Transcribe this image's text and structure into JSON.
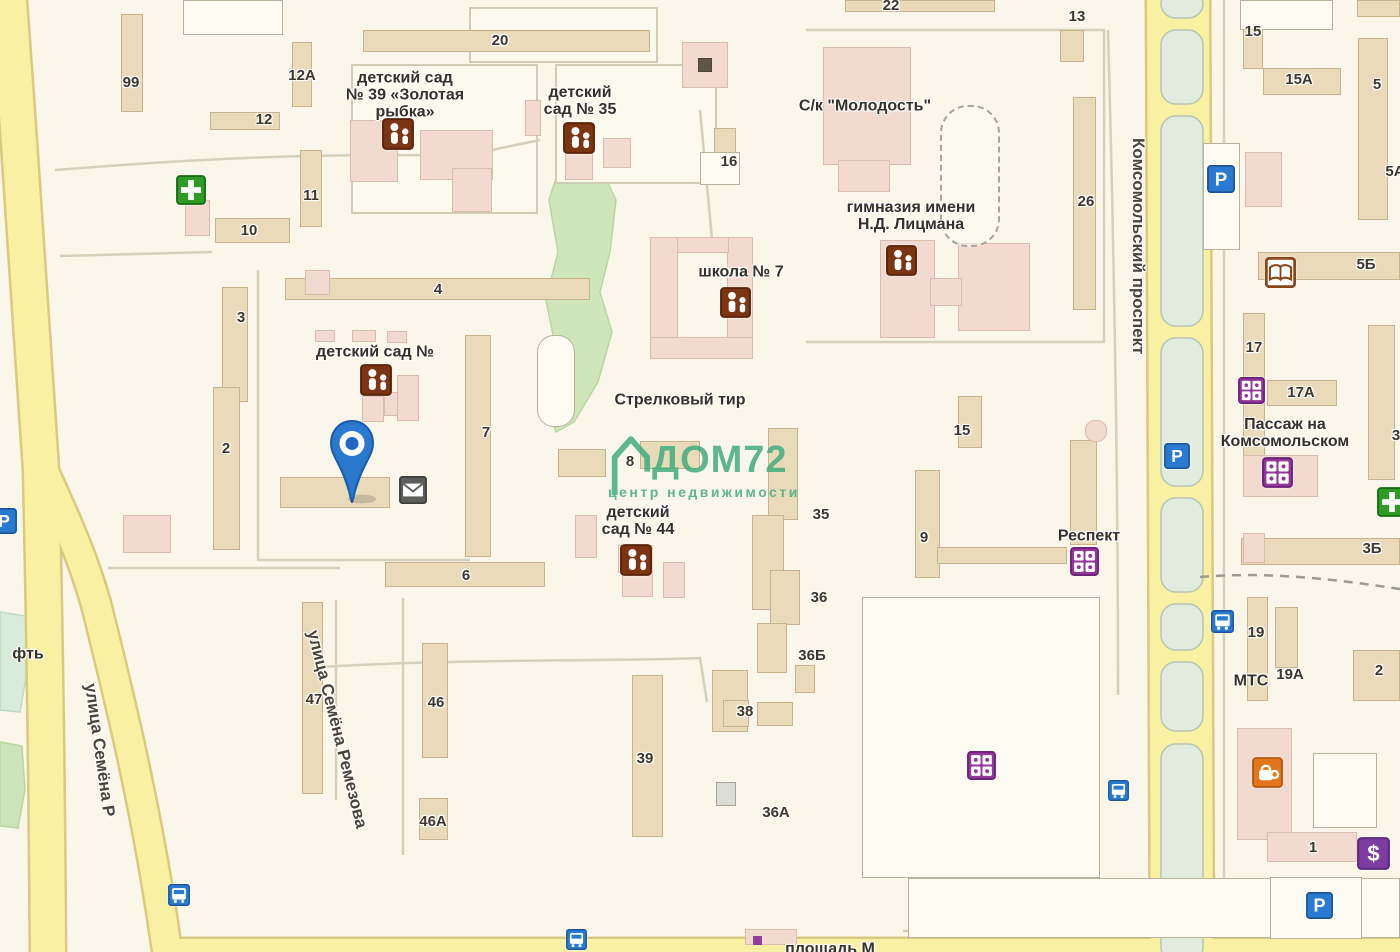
{
  "map": {
    "bg": "#faf6ea",
    "watermark": {
      "line1": "ДОМ72",
      "line2": "центр недвижимости",
      "color": "#43ad7c"
    },
    "pin": {
      "x": 352,
      "y": 504
    },
    "palette": {
      "road": "#f8f1a4",
      "road_casing": "#d8ca80",
      "building_tan": "#e9dbba",
      "building_pink": "#f2dad1",
      "green": "#cfe6ba",
      "median": "#e1ecdf",
      "icon_blue": "#2a7ad2",
      "icon_green": "#2f9b27",
      "icon_purple": "#93379b",
      "icon_brown": "#7c3512",
      "icon_orange": "#e2761b"
    },
    "median_x": 1161,
    "median_w": 42,
    "medians": [
      [
        -10,
        18
      ],
      [
        30,
        104
      ],
      [
        116,
        326
      ],
      [
        338,
        486
      ],
      [
        498,
        592
      ],
      [
        604,
        650
      ],
      [
        662,
        731
      ],
      [
        744,
        962
      ]
    ],
    "roads": [
      {
        "d": "M 8,-12 C 20,150 31,320 41,470 C 45,640 47,800 48,962",
        "w": 34
      },
      {
        "d": "M 41,465 C 60,508 80,548 96,604 C 116,684 148,810 168,958",
        "w": 28
      },
      {
        "d": "M 1178,-10 C 1181,200 1182,500 1182,962",
        "w": 62
      },
      {
        "d": "M 160,949 L 1406,949",
        "w": 20
      }
    ],
    "greens": [
      {
        "p": "575,148 600,166 616,200 610,252 600,292 612,332 598,382 574,422 556,432 546,400 556,350 546,300 558,252 549,200 560,165",
        "f": "#cfe6ba",
        "s": "#b9d6a2"
      },
      {
        "p": "0,612 26,616 29,660 20,712 0,710",
        "f": "#d9ecd9",
        "s": "#c2d9c2"
      },
      {
        "p": "0,742 22,746 25,790 18,828 0,826",
        "f": "#cde4ba",
        "s": "#b9d6a2"
      }
    ],
    "blocks": [
      "M 352,65 H 537 V 213 H 352 Z",
      "M 556,65 H 716 V 183 H 556 Z",
      "M 470,8 H 657 V 62 H 470 Z"
    ],
    "lanes": [
      {
        "d": "M 55,170 C 180,160 320,152 462,156 L 540,140"
      },
      {
        "d": "M 60,256 L 212,252"
      },
      {
        "d": "M 806,30 L 1104,30 L 1104,342 L 806,342"
      },
      {
        "d": "M 258,270 L 258,560 L 470,560"
      },
      {
        "d": "M 108,568 L 340,568"
      },
      {
        "d": "M 336,600 L 336,800"
      },
      {
        "d": "M 403,598 L 403,855"
      },
      {
        "d": "M 305,668 C 460,658 600,662 700,658 L 707,702"
      },
      {
        "d": "M 1224,0 L 1224,933"
      },
      {
        "d": "M 1108,30 C 1114,250 1118,460 1118,695"
      },
      {
        "d": "M 903,931 L 1400,931"
      },
      {
        "d": "M 700,110 L 713,250"
      },
      {
        "d": "M 1200,577 C 1270,571 1340,580 1400,589",
        "dash": "9 7",
        "c": "#9b9b93"
      }
    ],
    "buildings": [
      {
        "x": 121,
        "y": 14,
        "w": 22,
        "h": 98,
        "t": "t"
      },
      {
        "x": 292,
        "y": 42,
        "w": 20,
        "h": 65,
        "t": "t"
      },
      {
        "x": 210,
        "y": 112,
        "w": 70,
        "h": 18,
        "t": "t"
      },
      {
        "x": 300,
        "y": 150,
        "w": 22,
        "h": 77,
        "t": "t"
      },
      {
        "x": 215,
        "y": 218,
        "w": 75,
        "h": 25,
        "t": "t"
      },
      {
        "x": 363,
        "y": 30,
        "w": 287,
        "h": 22,
        "t": "t"
      },
      {
        "x": 845,
        "y": 0,
        "w": 150,
        "h": 12,
        "t": "t"
      },
      {
        "x": 1060,
        "y": 30,
        "w": 24,
        "h": 32,
        "t": "t"
      },
      {
        "x": 714,
        "y": 128,
        "w": 22,
        "h": 26,
        "t": "t"
      },
      {
        "x": 1073,
        "y": 97,
        "w": 23,
        "h": 213,
        "t": "t"
      },
      {
        "x": 285,
        "y": 278,
        "w": 305,
        "h": 22,
        "t": "t"
      },
      {
        "x": 222,
        "y": 287,
        "w": 26,
        "h": 115,
        "t": "t"
      },
      {
        "x": 213,
        "y": 387,
        "w": 27,
        "h": 163,
        "t": "t"
      },
      {
        "x": 465,
        "y": 335,
        "w": 26,
        "h": 222,
        "t": "t"
      },
      {
        "x": 280,
        "y": 477,
        "w": 110,
        "h": 31,
        "t": "t"
      },
      {
        "x": 558,
        "y": 449,
        "w": 48,
        "h": 28,
        "t": "t"
      },
      {
        "x": 640,
        "y": 441,
        "w": 60,
        "h": 28,
        "t": "t"
      },
      {
        "x": 385,
        "y": 562,
        "w": 160,
        "h": 25,
        "t": "t"
      },
      {
        "x": 768,
        "y": 428,
        "w": 30,
        "h": 92,
        "t": "t"
      },
      {
        "x": 752,
        "y": 515,
        "w": 32,
        "h": 95,
        "t": "t"
      },
      {
        "x": 770,
        "y": 570,
        "w": 30,
        "h": 55,
        "t": "t"
      },
      {
        "x": 757,
        "y": 623,
        "w": 30,
        "h": 50,
        "t": "t"
      },
      {
        "x": 712,
        "y": 670,
        "w": 36,
        "h": 62,
        "t": "t"
      },
      {
        "x": 795,
        "y": 665,
        "w": 20,
        "h": 28,
        "t": "t"
      },
      {
        "x": 757,
        "y": 702,
        "w": 36,
        "h": 24,
        "t": "t"
      },
      {
        "x": 723,
        "y": 700,
        "w": 26,
        "h": 27,
        "t": "t"
      },
      {
        "x": 632,
        "y": 675,
        "w": 31,
        "h": 162,
        "t": "t"
      },
      {
        "x": 422,
        "y": 643,
        "w": 26,
        "h": 115,
        "t": "t"
      },
      {
        "x": 419,
        "y": 798,
        "w": 29,
        "h": 42,
        "t": "t"
      },
      {
        "x": 302,
        "y": 602,
        "w": 21,
        "h": 192,
        "t": "t"
      },
      {
        "x": 915,
        "y": 470,
        "w": 25,
        "h": 108,
        "t": "t"
      },
      {
        "x": 958,
        "y": 396,
        "w": 24,
        "h": 52,
        "t": "t"
      },
      {
        "x": 1070,
        "y": 440,
        "w": 27,
        "h": 105,
        "t": "t"
      },
      {
        "x": 937,
        "y": 547,
        "w": 130,
        "h": 17,
        "t": "t"
      },
      {
        "x": 1243,
        "y": 7,
        "w": 20,
        "h": 62,
        "t": "t"
      },
      {
        "x": 1263,
        "y": 68,
        "w": 78,
        "h": 27,
        "t": "t"
      },
      {
        "x": 1358,
        "y": 38,
        "w": 30,
        "h": 182,
        "t": "t"
      },
      {
        "x": 1258,
        "y": 252,
        "w": 142,
        "h": 28,
        "t": "t"
      },
      {
        "x": 1243,
        "y": 313,
        "w": 22,
        "h": 152,
        "t": "t"
      },
      {
        "x": 1267,
        "y": 380,
        "w": 70,
        "h": 26,
        "t": "t"
      },
      {
        "x": 1368,
        "y": 325,
        "w": 27,
        "h": 155,
        "t": "t"
      },
      {
        "x": 1241,
        "y": 538,
        "w": 159,
        "h": 27,
        "t": "t"
      },
      {
        "x": 1247,
        "y": 597,
        "w": 21,
        "h": 104,
        "t": "t"
      },
      {
        "x": 1275,
        "y": 607,
        "w": 23,
        "h": 61,
        "t": "t"
      },
      {
        "x": 1353,
        "y": 650,
        "w": 47,
        "h": 51,
        "t": "t"
      },
      {
        "x": 1357,
        "y": 0,
        "w": 43,
        "h": 17,
        "t": "t"
      },
      {
        "x": 185,
        "y": 200,
        "w": 25,
        "h": 36,
        "t": "p"
      },
      {
        "x": 305,
        "y": 270,
        "w": 25,
        "h": 25,
        "t": "p"
      },
      {
        "x": 350,
        "y": 120,
        "w": 48,
        "h": 62,
        "t": "p"
      },
      {
        "x": 420,
        "y": 130,
        "w": 73,
        "h": 50,
        "t": "p"
      },
      {
        "x": 452,
        "y": 168,
        "w": 40,
        "h": 44,
        "t": "p"
      },
      {
        "x": 525,
        "y": 100,
        "w": 16,
        "h": 36,
        "t": "p"
      },
      {
        "x": 565,
        "y": 138,
        "w": 28,
        "h": 42,
        "t": "p"
      },
      {
        "x": 603,
        "y": 138,
        "w": 28,
        "h": 30,
        "t": "p"
      },
      {
        "x": 682,
        "y": 42,
        "w": 46,
        "h": 46,
        "t": "p"
      },
      {
        "x": 698,
        "y": 58,
        "w": 14,
        "h": 14,
        "t": "dark"
      },
      {
        "x": 823,
        "y": 47,
        "w": 88,
        "h": 118,
        "t": "p"
      },
      {
        "x": 838,
        "y": 160,
        "w": 52,
        "h": 32,
        "t": "p"
      },
      {
        "x": 880,
        "y": 240,
        "w": 55,
        "h": 98,
        "t": "p"
      },
      {
        "x": 958,
        "y": 243,
        "w": 72,
        "h": 88,
        "t": "p"
      },
      {
        "x": 930,
        "y": 278,
        "w": 32,
        "h": 28,
        "t": "p"
      },
      {
        "x": 650,
        "y": 237,
        "w": 28,
        "h": 122,
        "t": "p"
      },
      {
        "x": 727,
        "y": 237,
        "w": 26,
        "h": 122,
        "t": "p"
      },
      {
        "x": 650,
        "y": 337,
        "w": 103,
        "h": 22,
        "t": "p"
      },
      {
        "x": 677,
        "y": 237,
        "w": 52,
        "h": 16,
        "t": "p"
      },
      {
        "x": 362,
        "y": 396,
        "w": 22,
        "h": 26,
        "t": "p"
      },
      {
        "x": 384,
        "y": 392,
        "w": 15,
        "h": 24,
        "t": "p"
      },
      {
        "x": 397,
        "y": 375,
        "w": 22,
        "h": 46,
        "t": "p"
      },
      {
        "x": 315,
        "y": 330,
        "w": 20,
        "h": 12,
        "t": "p"
      },
      {
        "x": 352,
        "y": 330,
        "w": 24,
        "h": 12,
        "t": "p"
      },
      {
        "x": 387,
        "y": 331,
        "w": 20,
        "h": 12,
        "t": "p"
      },
      {
        "x": 575,
        "y": 515,
        "w": 22,
        "h": 43,
        "t": "p"
      },
      {
        "x": 622,
        "y": 572,
        "w": 31,
        "h": 25,
        "t": "p"
      },
      {
        "x": 663,
        "y": 562,
        "w": 22,
        "h": 36,
        "t": "p"
      },
      {
        "x": 618,
        "y": 545,
        "w": 35,
        "h": 28,
        "t": "p"
      },
      {
        "x": 1245,
        "y": 152,
        "w": 37,
        "h": 55,
        "t": "p"
      },
      {
        "x": 1243,
        "y": 455,
        "w": 75,
        "h": 42,
        "t": "p"
      },
      {
        "x": 1243,
        "y": 533,
        "w": 22,
        "h": 30,
        "t": "p"
      },
      {
        "x": 1237,
        "y": 728,
        "w": 55,
        "h": 112,
        "t": "p"
      },
      {
        "x": 1267,
        "y": 832,
        "w": 90,
        "h": 30,
        "t": "p"
      },
      {
        "x": 123,
        "y": 515,
        "w": 48,
        "h": 38,
        "t": "p"
      },
      {
        "x": 745,
        "y": 929,
        "w": 52,
        "h": 16,
        "t": "p"
      },
      {
        "x": 1085,
        "y": 420,
        "w": 22,
        "h": 22,
        "t": "p",
        "r": 10
      },
      {
        "x": 753,
        "y": 936,
        "w": 9,
        "h": 9,
        "t": "purple"
      },
      {
        "x": 183,
        "y": 0,
        "w": 100,
        "h": 35,
        "t": "w"
      },
      {
        "x": 700,
        "y": 152,
        "w": 40,
        "h": 33,
        "t": "w"
      },
      {
        "x": 1203,
        "y": 143,
        "w": 37,
        "h": 107,
        "t": "w"
      },
      {
        "x": 1240,
        "y": 0,
        "w": 93,
        "h": 30,
        "t": "w"
      },
      {
        "x": 537,
        "y": 335,
        "w": 38,
        "h": 92,
        "t": "w",
        "r": 17
      },
      {
        "x": 862,
        "y": 597,
        "w": 238,
        "h": 281,
        "t": "w"
      },
      {
        "x": 908,
        "y": 878,
        "w": 492,
        "h": 60,
        "t": "w"
      },
      {
        "x": 1313,
        "y": 753,
        "w": 64,
        "h": 75,
        "t": "w"
      },
      {
        "x": 1270,
        "y": 877,
        "w": 92,
        "h": 62,
        "t": "w"
      },
      {
        "x": 716,
        "y": 782,
        "w": 20,
        "h": 24,
        "t": "g"
      },
      {
        "x": 940,
        "y": 105,
        "w": 60,
        "h": 142,
        "t": "dash"
      }
    ],
    "labels": [
      {
        "x": 131,
        "y": 83,
        "t": "99"
      },
      {
        "x": 302,
        "y": 76,
        "t": "12А"
      },
      {
        "x": 264,
        "y": 120,
        "t": "12"
      },
      {
        "x": 311,
        "y": 196,
        "t": "11"
      },
      {
        "x": 249,
        "y": 231,
        "t": "10"
      },
      {
        "x": 500,
        "y": 41,
        "t": "20"
      },
      {
        "x": 891,
        "y": 6,
        "t": "22"
      },
      {
        "x": 1077,
        "y": 17,
        "t": "13"
      },
      {
        "x": 1253,
        "y": 32,
        "t": "15"
      },
      {
        "x": 1299,
        "y": 80,
        "t": "15А"
      },
      {
        "x": 1377,
        "y": 85,
        "t": "5"
      },
      {
        "x": 1395,
        "y": 172,
        "t": "5А"
      },
      {
        "x": 1366,
        "y": 265,
        "t": "5Б"
      },
      {
        "x": 729,
        "y": 162,
        "t": "16"
      },
      {
        "x": 1086,
        "y": 202,
        "t": "26"
      },
      {
        "x": 1254,
        "y": 348,
        "t": "17"
      },
      {
        "x": 1301,
        "y": 393,
        "t": "17А"
      },
      {
        "x": 1396,
        "y": 436,
        "t": "3"
      },
      {
        "x": 1372,
        "y": 549,
        "t": "3Б"
      },
      {
        "x": 1256,
        "y": 633,
        "t": "19"
      },
      {
        "x": 1290,
        "y": 675,
        "t": "19А"
      },
      {
        "x": 1379,
        "y": 671,
        "t": "2"
      },
      {
        "x": 1313,
        "y": 848,
        "t": "1"
      },
      {
        "x": 438,
        "y": 290,
        "t": "4"
      },
      {
        "x": 241,
        "y": 318,
        "t": "3"
      },
      {
        "x": 226,
        "y": 449,
        "t": "2"
      },
      {
        "x": 486,
        "y": 433,
        "t": "7"
      },
      {
        "x": 630,
        "y": 462,
        "t": "8"
      },
      {
        "x": 352,
        "y": 489,
        "t": "5"
      },
      {
        "x": 821,
        "y": 515,
        "t": "35"
      },
      {
        "x": 924,
        "y": 538,
        "t": "9"
      },
      {
        "x": 962,
        "y": 431,
        "t": "15"
      },
      {
        "x": 466,
        "y": 576,
        "t": "6"
      },
      {
        "x": 819,
        "y": 598,
        "t": "36"
      },
      {
        "x": 812,
        "y": 656,
        "t": "36Б"
      },
      {
        "x": 745,
        "y": 712,
        "t": "38"
      },
      {
        "x": 645,
        "y": 759,
        "t": "39"
      },
      {
        "x": 776,
        "y": 813,
        "t": "36А"
      },
      {
        "x": 436,
        "y": 703,
        "t": "46"
      },
      {
        "x": 433,
        "y": 822,
        "t": "46А"
      },
      {
        "x": 314,
        "y": 700,
        "t": "47"
      },
      {
        "x": 405,
        "y": 95,
        "t": "детский сад\n№ 39 «Золотая\nрыбка»",
        "c": "poi"
      },
      {
        "x": 580,
        "y": 101,
        "t": "детский\nсад № 35",
        "c": "poi"
      },
      {
        "x": 865,
        "y": 106,
        "t": "С/к \"Молодость\"",
        "c": "poi"
      },
      {
        "x": 911,
        "y": 216,
        "t": "гимназия имени\nН.Д. Лицмана",
        "c": "poi"
      },
      {
        "x": 741,
        "y": 272,
        "t": "школа № 7",
        "c": "poi"
      },
      {
        "x": 680,
        "y": 400,
        "t": "Стрелковый тир",
        "c": "poi"
      },
      {
        "x": 375,
        "y": 352,
        "t": "детский сад №",
        "c": "poi"
      },
      {
        "x": 638,
        "y": 521,
        "t": "детский\nсад № 44",
        "c": "poi"
      },
      {
        "x": 1285,
        "y": 433,
        "t": "Пассаж на\nКомсомольском",
        "c": "poi"
      },
      {
        "x": 1089,
        "y": 536,
        "t": "Респект",
        "c": "poi"
      },
      {
        "x": 1251,
        "y": 681,
        "t": "МТС",
        "c": "poi"
      },
      {
        "x": 28,
        "y": 654,
        "t": "фть",
        "c": "poi"
      },
      {
        "x": 830,
        "y": 949,
        "t": "площадь М",
        "c": "poi"
      }
    ],
    "streets": [
      {
        "x": 1148,
        "y": 138,
        "r": 90,
        "t": "Комсомольский проспект"
      },
      {
        "x": 322,
        "y": 628,
        "r": 76,
        "t": "улица Семёна Ремезова"
      },
      {
        "x": 100,
        "y": 682,
        "r": 82,
        "t": "улица Семёна Р"
      },
      {
        "x": -14,
        "y": 70,
        "r": 66,
        "t": "езова"
      }
    ],
    "icons": [
      {
        "x": 176,
        "y": 175,
        "s": 30,
        "k": "pharmacy"
      },
      {
        "x": 1377,
        "y": 487,
        "s": 30,
        "k": "pharmacy"
      },
      {
        "x": 1207,
        "y": 165,
        "s": 28,
        "k": "parking"
      },
      {
        "x": 1164,
        "y": 443,
        "s": 26,
        "k": "parking"
      },
      {
        "x": 1306,
        "y": 892,
        "s": 27,
        "k": "parking"
      },
      {
        "x": -9,
        "y": 508,
        "s": 26,
        "k": "parking"
      },
      {
        "x": 1211,
        "y": 610,
        "s": 23,
        "k": "bus"
      },
      {
        "x": 1108,
        "y": 780,
        "s": 21,
        "k": "bus"
      },
      {
        "x": 168,
        "y": 884,
        "s": 22,
        "k": "bus"
      },
      {
        "x": 566,
        "y": 929,
        "s": 21,
        "k": "bus"
      },
      {
        "x": 1265,
        "y": 257,
        "s": 31,
        "k": "book"
      },
      {
        "x": 1238,
        "y": 377,
        "s": 27,
        "k": "shop"
      },
      {
        "x": 1262,
        "y": 457,
        "s": 31,
        "k": "shop"
      },
      {
        "x": 1070,
        "y": 547,
        "s": 29,
        "k": "shop"
      },
      {
        "x": 967,
        "y": 751,
        "s": 29,
        "k": "shop"
      },
      {
        "x": 399,
        "y": 476,
        "s": 28,
        "k": "mail"
      },
      {
        "x": 1252,
        "y": 757,
        "s": 31,
        "k": "coffee"
      },
      {
        "x": 1357,
        "y": 837,
        "s": 33,
        "k": "dollar"
      },
      {
        "x": 382,
        "y": 118,
        "s": 32,
        "k": "school"
      },
      {
        "x": 563,
        "y": 122,
        "s": 32,
        "k": "school"
      },
      {
        "x": 886,
        "y": 245,
        "s": 31,
        "k": "school"
      },
      {
        "x": 720,
        "y": 287,
        "s": 31,
        "k": "school"
      },
      {
        "x": 360,
        "y": 364,
        "s": 32,
        "k": "school"
      },
      {
        "x": 620,
        "y": 544,
        "s": 32,
        "k": "school"
      }
    ]
  }
}
